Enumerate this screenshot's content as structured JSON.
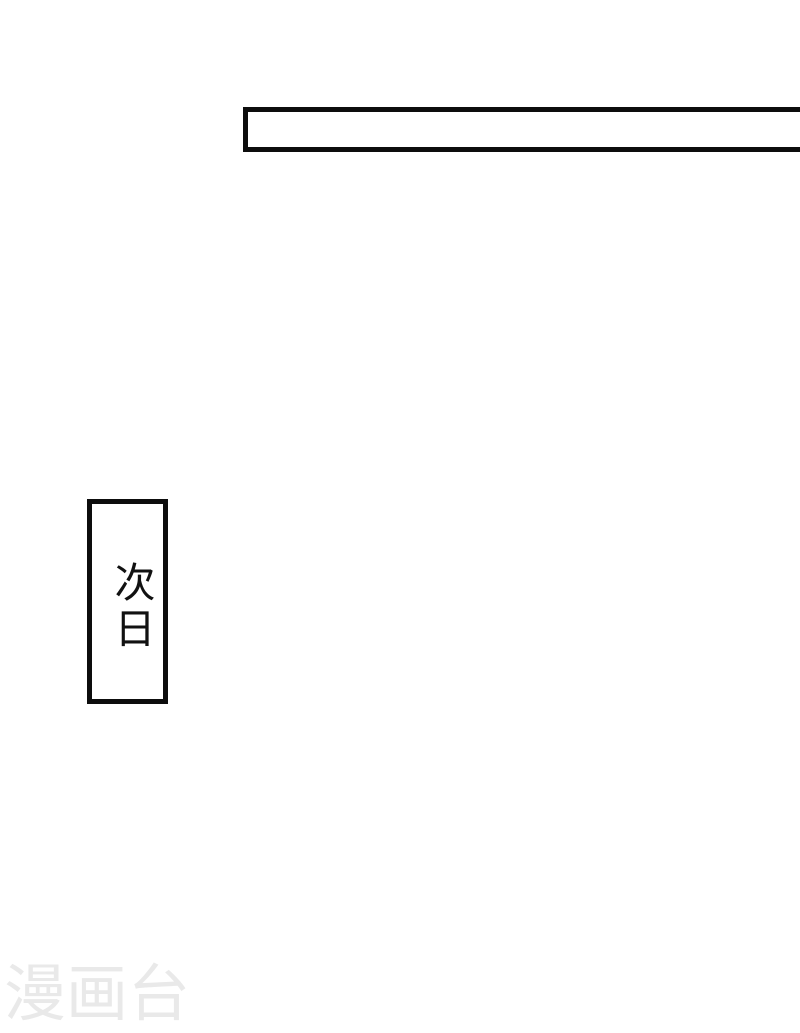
{
  "page": {
    "kind": "comic-page",
    "background_color": "#ffffff",
    "panel_border_color": "#0d0d0d"
  },
  "panels": {
    "top_banner": {
      "text": ""
    },
    "caption_box": {
      "text": "次日"
    }
  },
  "watermark": {
    "text": "漫画台",
    "color": "#e9e9e9"
  }
}
